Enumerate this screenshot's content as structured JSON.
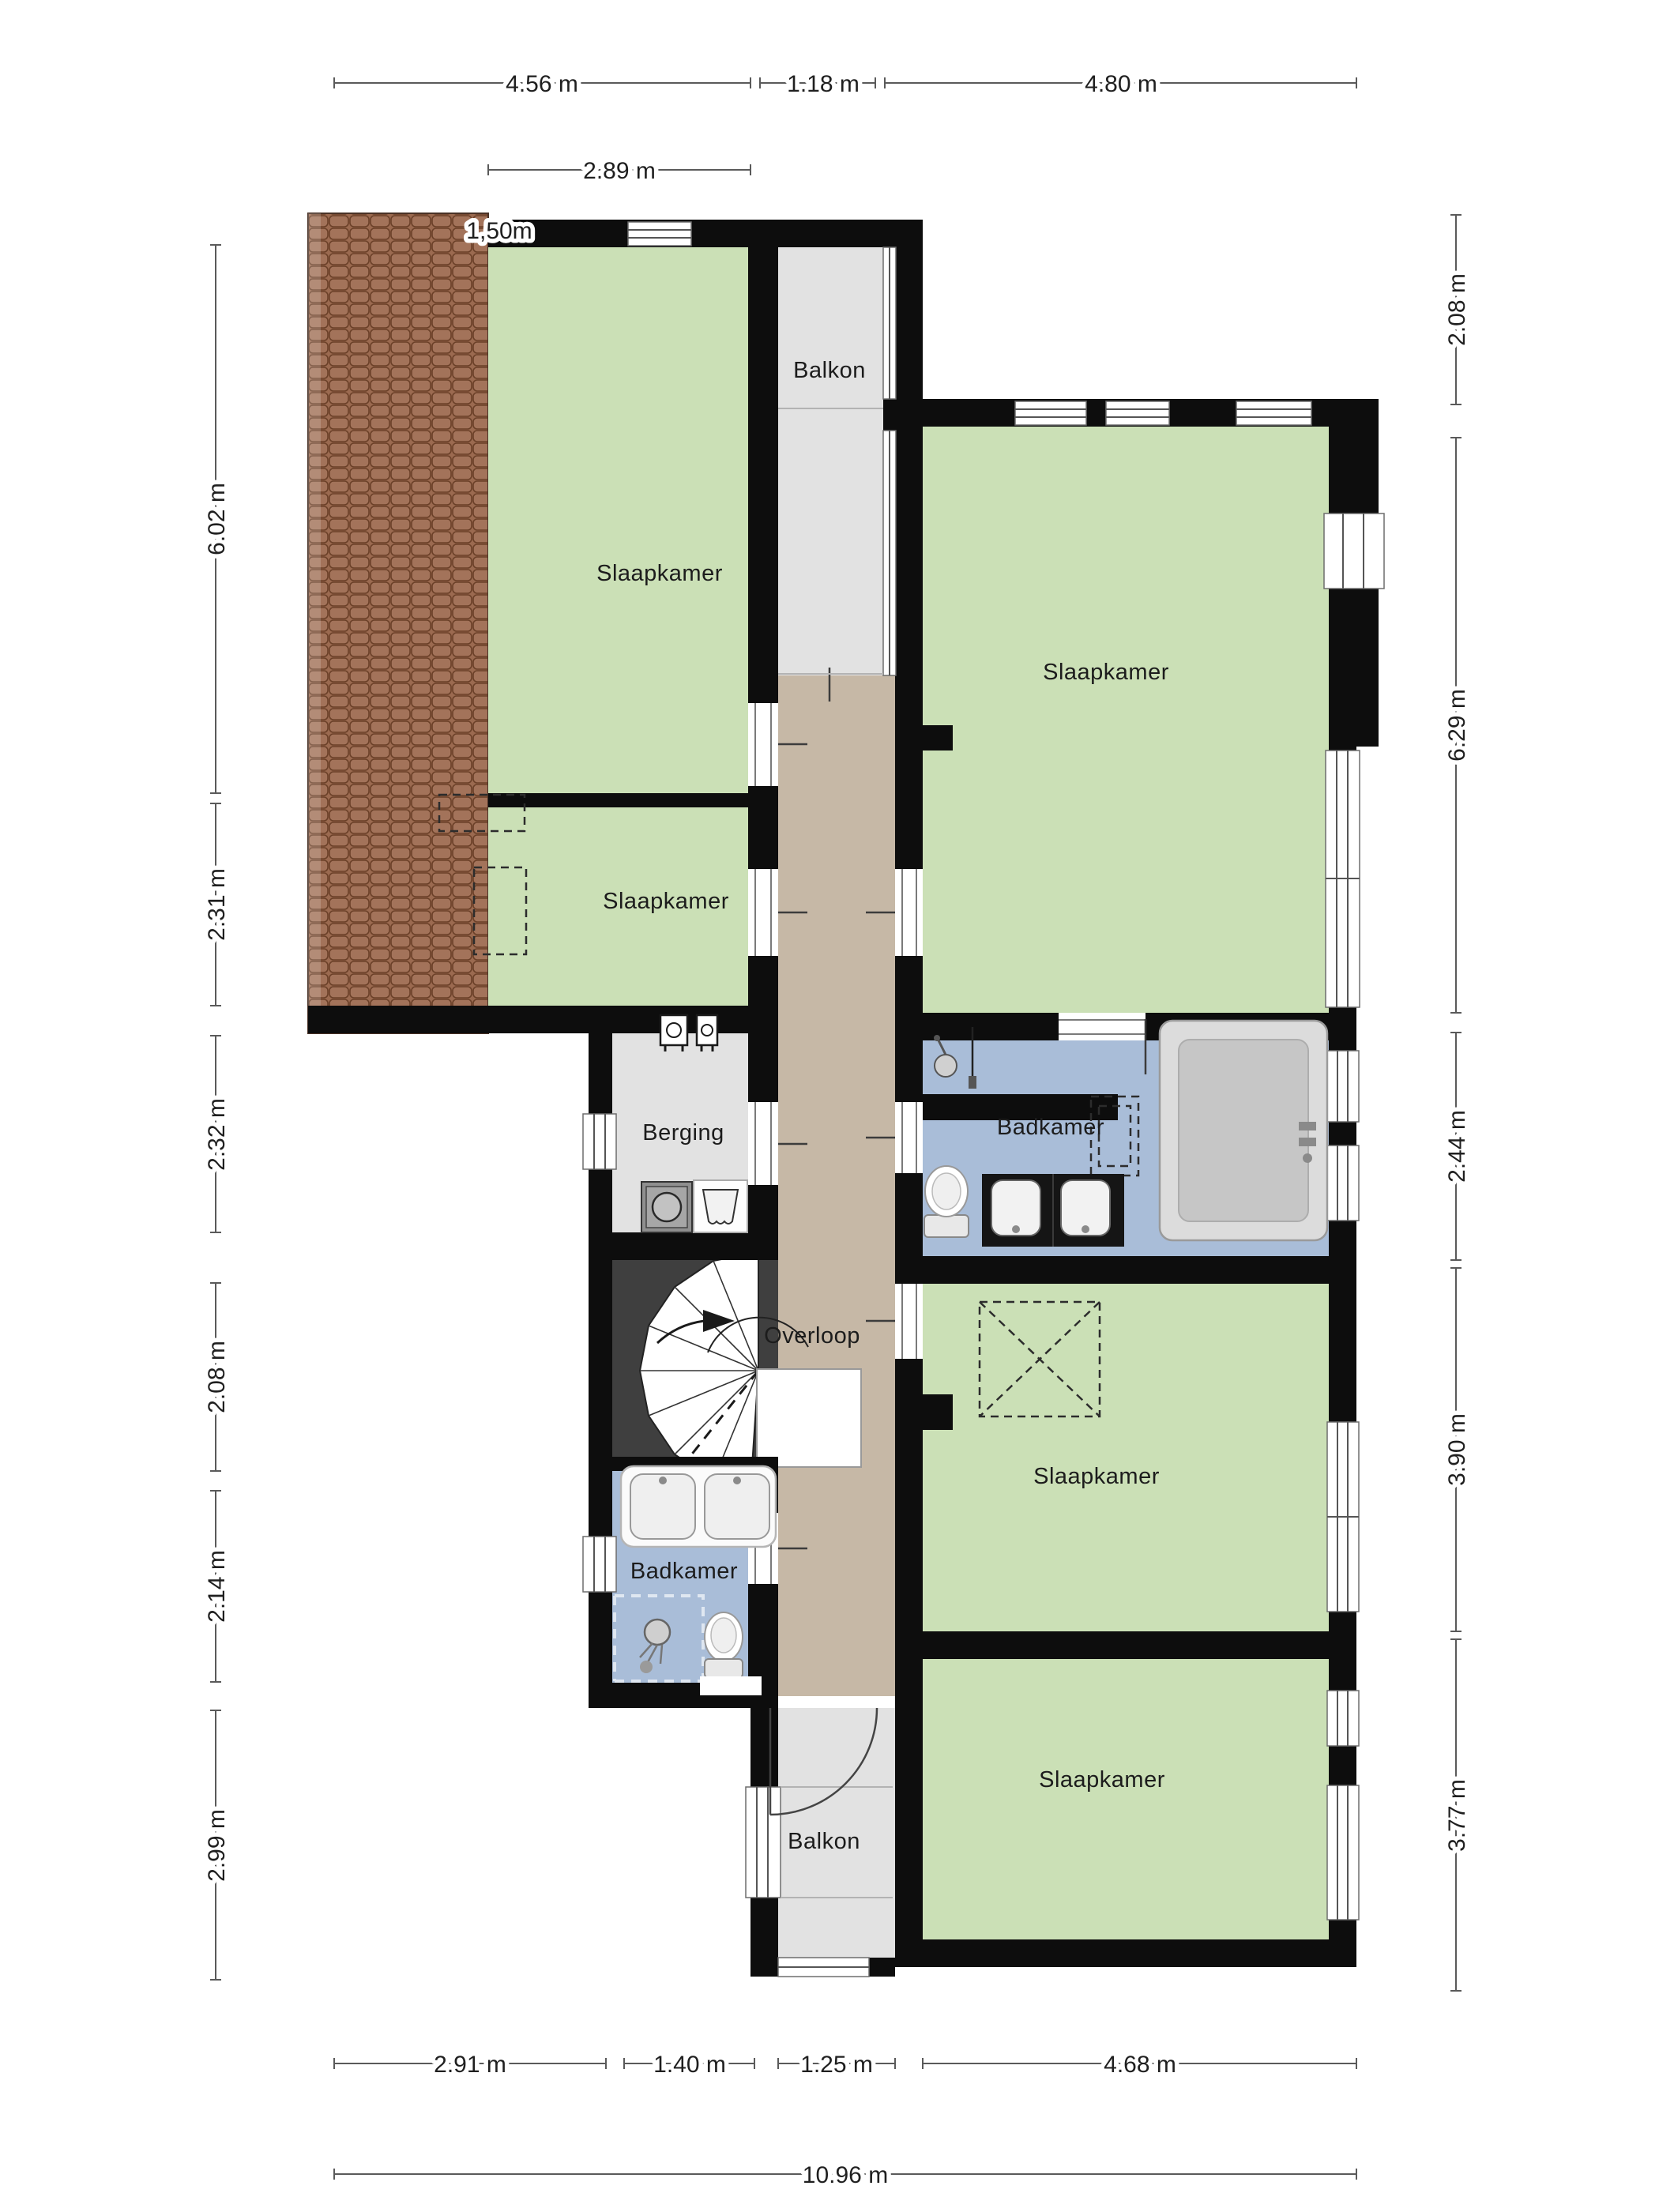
{
  "plan_title": "floor-plan-upper-storey",
  "rooms": {
    "slaapkamer_top_left": {
      "label": "Slaapkamer"
    },
    "slaapkamer_left_small": {
      "label": "Slaapkamer"
    },
    "slaapkamer_top_right": {
      "label": "Slaapkamer"
    },
    "slaapkamer_middle": {
      "label": "Slaapkamer"
    },
    "slaapkamer_bottom": {
      "label": "Slaapkamer"
    },
    "balkon_top": {
      "label": "Balkon"
    },
    "balkon_bottom": {
      "label": "Balkon"
    },
    "badkamer_right": {
      "label": "Badkamer"
    },
    "badkamer_left": {
      "label": "Badkamer"
    },
    "berging": {
      "label": "Berging"
    },
    "overloop": {
      "label": "Overloop"
    }
  },
  "dimensions": {
    "top": [
      "4.56 m",
      "1.18 m",
      "4.80 m"
    ],
    "top_secondary": "2.89 m",
    "roof_width_note": "1,50m",
    "left": [
      "6.02 m",
      "2.31 m",
      "2.32 m",
      "2.08 m",
      "2.14 m",
      "2.99 m"
    ],
    "right": [
      "2.08 m",
      "6.29 m",
      "2.44 m",
      "3.90 m",
      "3.77 m"
    ],
    "bottom": [
      "2.91 m",
      "1.40 m",
      "1.25 m",
      "4.68 m"
    ],
    "bottom_total": "10.96 m"
  },
  "colors": {
    "wall": "#0d0d0d",
    "room-green": "#cbe0b6",
    "room-blue": "#a9bdd8",
    "hall-tan": "#c6b8a6",
    "gray-floor": "#e2e2e2",
    "roof-brown": "#9b6a50",
    "roof-line": "#6b4028",
    "stair-dark": "#3f3f3f",
    "dim-line": "#5a5a5a",
    "text": "#1c1c1c"
  }
}
